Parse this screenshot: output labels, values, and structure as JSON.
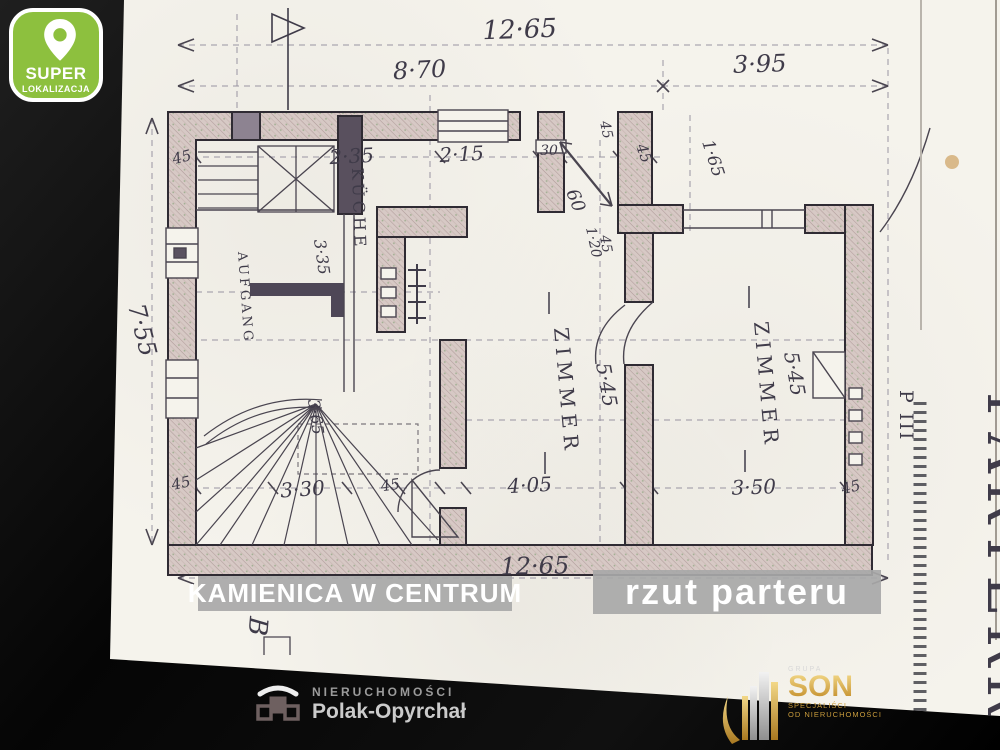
{
  "badge": {
    "title": "SUPER",
    "subtitle": "LOKALIZACJA"
  },
  "captions": {
    "property": "KAMIENICA W CENTRUM",
    "plan_title": "rzut parteru"
  },
  "plan": {
    "rooms": {
      "kitchen": "KÜCHE",
      "room_left": "ZIMMER",
      "room_right": "ZIMMER",
      "hall": "AUFGANG"
    },
    "marks": {
      "sheet_title": "PARTERRE",
      "sheet_code": "P III",
      "corner_note": "B"
    },
    "dims": {
      "top_total": "12·65",
      "top_left": "8·70",
      "top_right": "3·95",
      "left_total": "7·55",
      "bottom_total": "12·65",
      "kitchen_w": "2·35",
      "kitchen_door": "2·15",
      "kitchen_d": "3·35",
      "niche": "30",
      "t45a": "45",
      "t45b": "45",
      "t45c": "45",
      "c45": "45",
      "lobby_w": "60",
      "lobby_d": "1·20",
      "wing_offset": "1·65",
      "hall_d": "5·45",
      "room2_d": "5·45",
      "stair_w": "3·65",
      "b45a": "45",
      "b45b": "45",
      "b45c": "45",
      "stair_run": "3·30",
      "room1_w": "4·05",
      "room2_w": "3·50"
    }
  },
  "footer": {
    "left_logo": {
      "line1": "NIERUCHOMOŚCI",
      "line2": "Polak-Opyrchał"
    },
    "right_logo": {
      "group": "GRUPA",
      "name": "SON",
      "tagline1": "SPECJALIŚCI",
      "tagline2": "OD NIERUCHOMOŚCI"
    }
  },
  "colors": {
    "badge_green": "#8dc03e",
    "caption_bg": "#a8a8a8",
    "gold": "#d9a93f",
    "paper": "#f5f3ec"
  }
}
